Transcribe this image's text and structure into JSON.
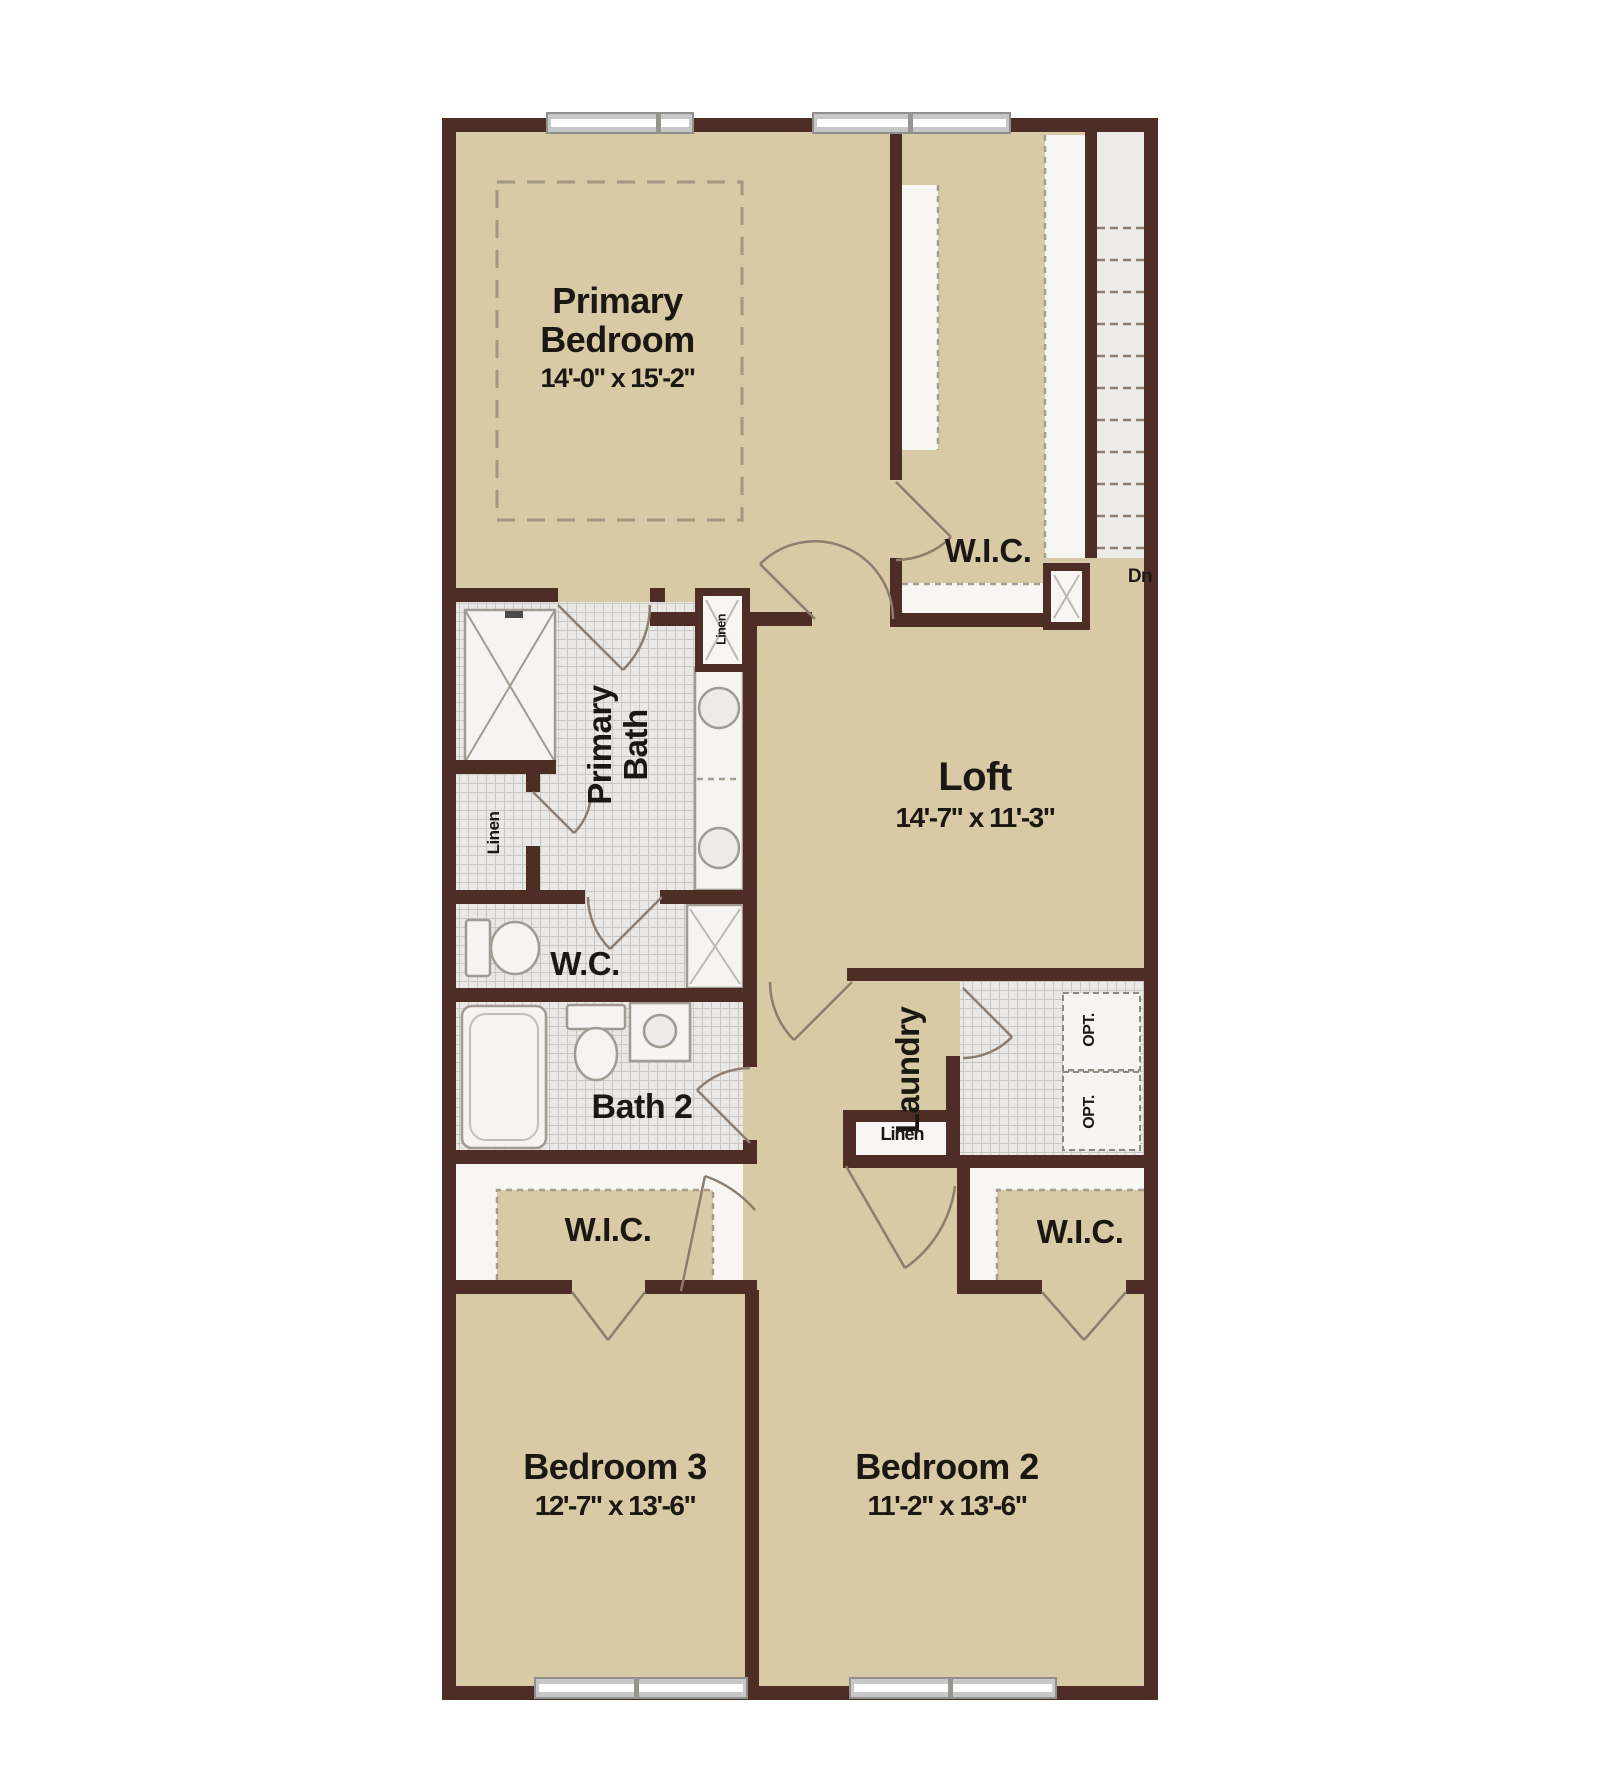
{
  "plan": {
    "type": "floor-plan",
    "rooms": {
      "primary_bedroom": {
        "name": "Primary Bedroom",
        "dims": "14'-0\" x 15'-2\""
      },
      "primary_wic": {
        "name": "W.I.C."
      },
      "primary_bath": {
        "name": "Primary Bath"
      },
      "wc": {
        "name": "W.C."
      },
      "bath2": {
        "name": "Bath 2"
      },
      "loft": {
        "name": "Loft",
        "dims": "14'-7\" x 11'-3\""
      },
      "laundry": {
        "name": "Laundry"
      },
      "wic_bedroom3": {
        "name": "W.I.C."
      },
      "wic_bedroom2": {
        "name": "W.I.C."
      },
      "bedroom3": {
        "name": "Bedroom 3",
        "dims": "12'-7\" x 13'-6\""
      },
      "bedroom2": {
        "name": "Bedroom 2",
        "dims": "11'-2\" x 13'-6\""
      }
    },
    "labels": {
      "stairs_down": "Dn",
      "linen_hall": "Linen",
      "linen_bath": "Linen",
      "linen_cabinet": "Linen",
      "optional_appliance": "OPT."
    },
    "colors": {
      "wall": "#4e2d27",
      "floor": "#d8caa4",
      "tile": "#e9e8e5",
      "shelf": "#f7f6f2",
      "stairs": "#edebe7",
      "window": "#c7c7c7",
      "door": "#8d7d6e",
      "fixture": "#a19b92",
      "text": "#1b1713"
    }
  }
}
